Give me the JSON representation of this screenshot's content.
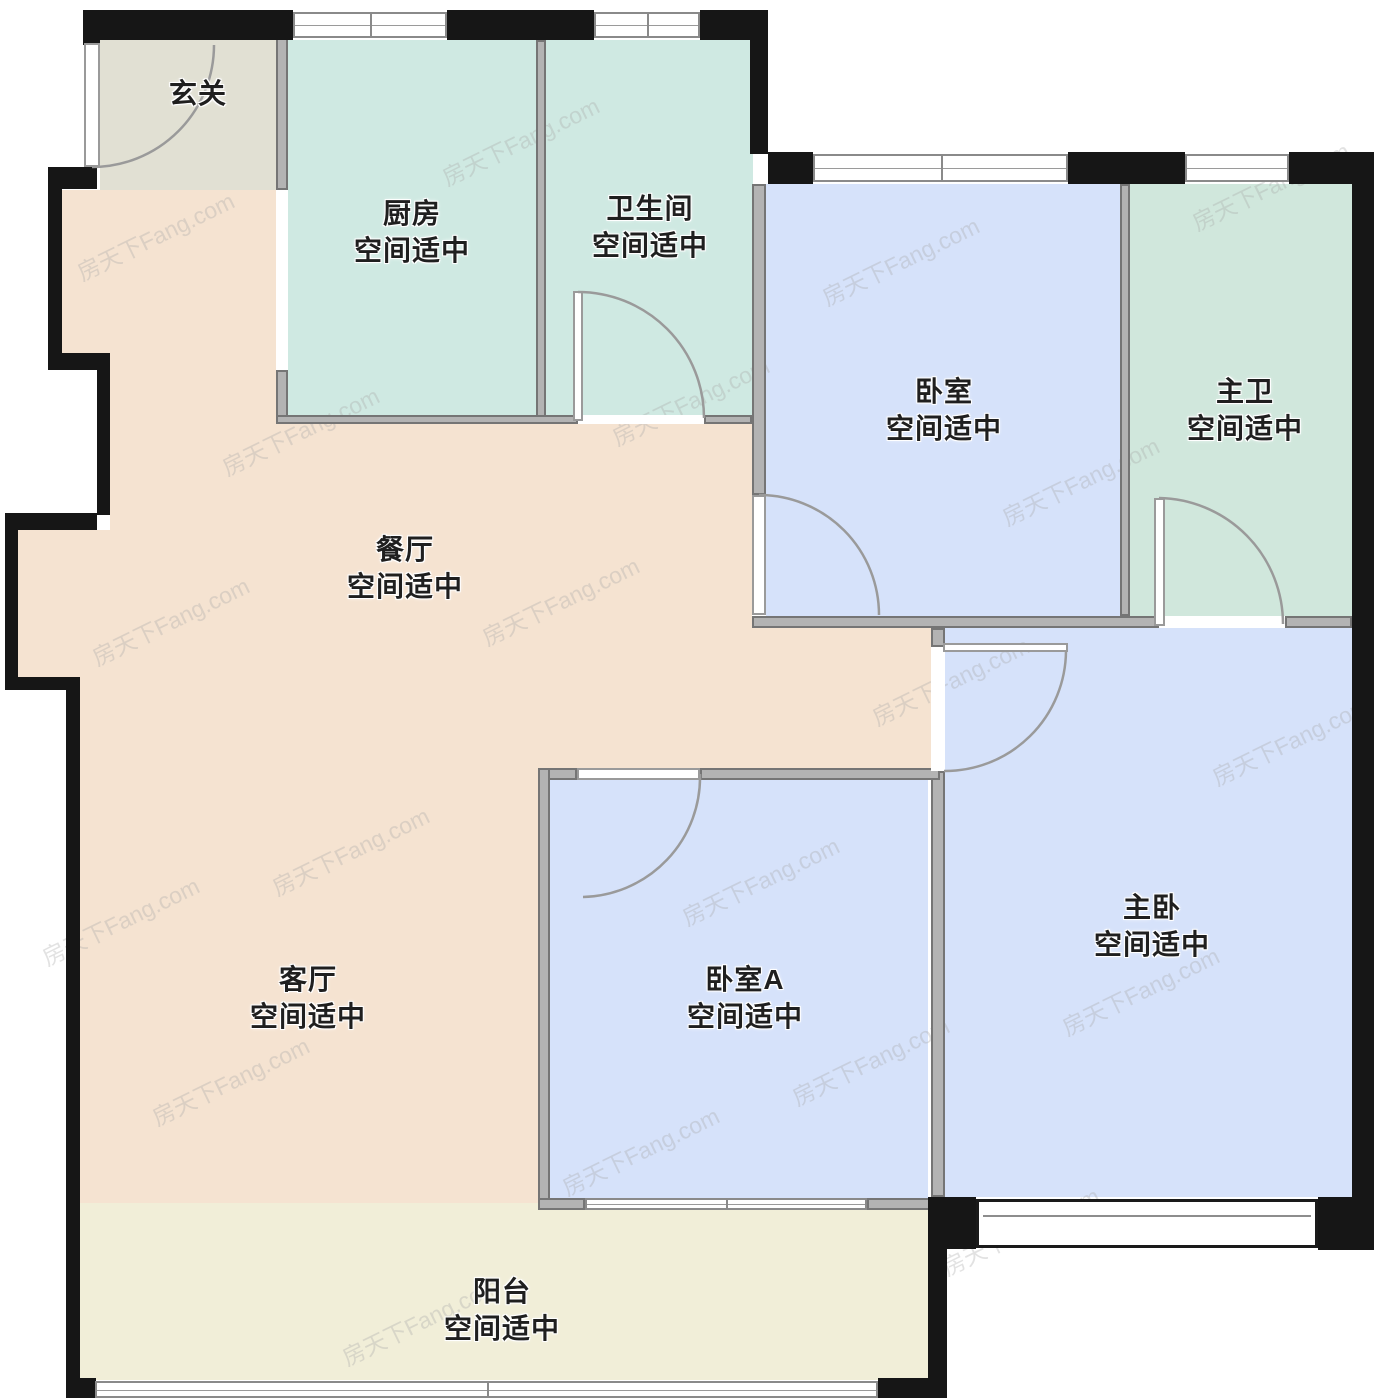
{
  "meta": {
    "title": "户型图 (floor plan)",
    "watermark_text": "房天下Fang.com",
    "canvas": {
      "width": 1374,
      "height": 1400
    }
  },
  "palette": {
    "outer_wall": "#161616",
    "inner_wall": "#b3b3b3",
    "teal_room": "#cfe9e2",
    "teal_room_dark": "#d0e7dc",
    "blue_room": "#d6e2fa",
    "peach_room": "#f5e3d1",
    "cream_room": "#f1eed8",
    "foyer_gray": "#e1e0d3",
    "arc_stroke": "#9a9a9a"
  },
  "fills": [
    {
      "id": "foyer",
      "color": "#e1e0d3",
      "rects": [
        [
          100,
          40,
          176,
          150
        ]
      ]
    },
    {
      "id": "kitchen",
      "color": "#cfe9e2",
      "rects": [
        [
          288,
          40,
          248,
          378
        ]
      ]
    },
    {
      "id": "bathroom",
      "color": "#cfe9e2",
      "rects": [
        [
          546,
          40,
          207,
          378
        ]
      ]
    },
    {
      "id": "bedroom",
      "color": "#d6e2fa",
      "rects": [
        [
          766,
          184,
          354,
          432
        ]
      ]
    },
    {
      "id": "master-bath",
      "color": "#d0e7dc",
      "rects": [
        [
          1130,
          184,
          222,
          432
        ]
      ]
    },
    {
      "id": "dining-living",
      "color": "#f5e3d1",
      "rects": [
        [
          62,
          190,
          214,
          165
        ],
        [
          110,
          353,
          166,
          70
        ],
        [
          110,
          423,
          642,
          107
        ],
        [
          18,
          530,
          734,
          147
        ],
        [
          752,
          628,
          179,
          140
        ],
        [
          78,
          677,
          460,
          526
        ],
        [
          538,
          677,
          393,
          91
        ]
      ]
    },
    {
      "id": "master-bedroom",
      "color": "#d6e2fa",
      "rects": [
        [
          945,
          628,
          407,
          569
        ]
      ]
    },
    {
      "id": "bedroom-a",
      "color": "#d6e2fa",
      "rects": [
        [
          550,
          780,
          378,
          418
        ]
      ]
    },
    {
      "id": "balcony",
      "color": "#f1eed8",
      "rects": [
        [
          80,
          1203,
          848,
          177
        ]
      ]
    }
  ],
  "labels": [
    {
      "id": "foyer",
      "lines": [
        "玄关"
      ],
      "x": 198,
      "y": 92
    },
    {
      "id": "kitchen",
      "lines": [
        "厨房",
        "空间适中"
      ],
      "x": 412,
      "y": 212
    },
    {
      "id": "bathroom",
      "lines": [
        "卫生间",
        "空间适中"
      ],
      "x": 650,
      "y": 207
    },
    {
      "id": "bedroom",
      "lines": [
        "卧室",
        "空间适中"
      ],
      "x": 944,
      "y": 390
    },
    {
      "id": "master-bath",
      "lines": [
        "主卫",
        "空间适中"
      ],
      "x": 1245,
      "y": 390
    },
    {
      "id": "dining",
      "lines": [
        "餐厅",
        "空间适中"
      ],
      "x": 405,
      "y": 548
    },
    {
      "id": "living",
      "lines": [
        "客厅",
        "空间适中"
      ],
      "x": 308,
      "y": 978
    },
    {
      "id": "bedroom-a",
      "lines": [
        "卧室A",
        "空间适中"
      ],
      "x": 745,
      "y": 978
    },
    {
      "id": "master-bedroom",
      "lines": [
        "主卧",
        "空间适中"
      ],
      "x": 1152,
      "y": 906
    },
    {
      "id": "balcony",
      "lines": [
        "阳台",
        "空间适中"
      ],
      "x": 502,
      "y": 1290
    }
  ],
  "walls": {
    "outer": [
      [
        83,
        10,
        210,
        30
      ],
      [
        447,
        10,
        147,
        30
      ],
      [
        700,
        10,
        68,
        30
      ],
      [
        750,
        38,
        18,
        116
      ],
      [
        768,
        152,
        45,
        32
      ],
      [
        1068,
        152,
        117,
        32
      ],
      [
        1289,
        152,
        85,
        32
      ],
      [
        1352,
        152,
        22,
        1062
      ],
      [
        1318,
        1197,
        56,
        53
      ],
      [
        928,
        1197,
        48,
        52
      ],
      [
        928,
        1249,
        19,
        149
      ],
      [
        66,
        1378,
        30,
        20
      ],
      [
        878,
        1378,
        50,
        20
      ],
      [
        83,
        10,
        17,
        35
      ],
      [
        48,
        167,
        49,
        22
      ],
      [
        48,
        167,
        14,
        190
      ],
      [
        48,
        353,
        62,
        17
      ],
      [
        97,
        353,
        13,
        162
      ],
      [
        5,
        513,
        92,
        17
      ],
      [
        5,
        513,
        13,
        168
      ],
      [
        5,
        677,
        73,
        13
      ],
      [
        66,
        677,
        14,
        703
      ]
    ],
    "inner": [
      [
        276,
        30,
        12,
        160
      ],
      [
        276,
        370,
        12,
        53
      ],
      [
        536,
        40,
        10,
        383
      ],
      [
        276,
        415,
        302,
        9
      ],
      [
        704,
        415,
        48,
        9
      ],
      [
        752,
        184,
        14,
        311
      ],
      [
        752,
        616,
        407,
        12
      ],
      [
        1285,
        616,
        67,
        12
      ],
      [
        1120,
        184,
        10,
        432
      ],
      [
        931,
        628,
        14,
        19
      ],
      [
        931,
        771,
        14,
        426
      ],
      [
        538,
        768,
        39,
        12
      ],
      [
        700,
        768,
        240,
        12
      ],
      [
        538,
        768,
        12,
        442
      ],
      [
        538,
        1198,
        47,
        12
      ],
      [
        867,
        1198,
        64,
        12
      ]
    ]
  },
  "windows": [
    {
      "rect": [
        293,
        12,
        154,
        26
      ],
      "panes": 2
    },
    {
      "rect": [
        594,
        12,
        106,
        26
      ],
      "panes": 2
    },
    {
      "rect": [
        813,
        154,
        255,
        28
      ],
      "panes": 2
    },
    {
      "rect": [
        1185,
        154,
        104,
        28
      ],
      "panes": 1
    },
    {
      "rect": [
        585,
        1198,
        282,
        12
      ],
      "panes": 2
    },
    {
      "rect": [
        95,
        1381,
        783,
        17
      ],
      "panes": 2
    }
  ],
  "bay_window": {
    "rect": [
      976,
      1199,
      342,
      49
    ]
  },
  "doors": [
    {
      "id": "entrance",
      "opening": [
        84,
        43,
        16,
        124
      ],
      "leaf": [
        84,
        43,
        16,
        124
      ],
      "arc": {
        "from": [
          92,
          167
        ],
        "to": [
          214,
          45
        ],
        "r": 122,
        "sweep": 0
      }
    },
    {
      "id": "bathroom",
      "opening": [
        578,
        415,
        126,
        9
      ],
      "leaf": [
        573,
        291,
        10,
        130
      ],
      "arc": {
        "from": [
          578,
          292
        ],
        "to": [
          704,
          418
        ],
        "r": 126,
        "sweep": 1
      }
    },
    {
      "id": "bedroom",
      "opening": [
        752,
        495,
        14,
        120
      ],
      "leaf": [
        752,
        495,
        14,
        120
      ],
      "arc": {
        "from": [
          759,
          495
        ],
        "to": [
          879,
          615
        ],
        "r": 120,
        "sweep": 1
      }
    },
    {
      "id": "master-bath",
      "opening": [
        1159,
        616,
        126,
        12
      ],
      "leaf": [
        1154,
        498,
        11,
        128
      ],
      "arc": {
        "from": [
          1159,
          498
        ],
        "to": [
          1283,
          624
        ],
        "r": 126,
        "sweep": 1
      }
    },
    {
      "id": "master",
      "opening": [
        931,
        647,
        14,
        124
      ],
      "leaf": [
        943,
        643,
        125,
        9
      ],
      "arc": {
        "from": [
          1066,
          651
        ],
        "to": [
          944,
          771
        ],
        "r": 121,
        "sweep": 1
      }
    },
    {
      "id": "bedroom-a",
      "opening": [
        577,
        768,
        123,
        12
      ],
      "leaf": [
        577,
        768,
        123,
        12
      ],
      "arc": {
        "from": [
          700,
          774
        ],
        "to": [
          583,
          897
        ],
        "r": 120,
        "sweep": 1
      }
    }
  ],
  "watermarks": [
    [
      155,
      235
    ],
    [
      520,
      140
    ],
    [
      900,
      260
    ],
    [
      1270,
      185
    ],
    [
      300,
      430
    ],
    [
      690,
      400
    ],
    [
      1080,
      480
    ],
    [
      170,
      620
    ],
    [
      560,
      600
    ],
    [
      950,
      680
    ],
    [
      1290,
      740
    ],
    [
      350,
      850
    ],
    [
      760,
      880
    ],
    [
      1140,
      990
    ],
    [
      120,
      920
    ],
    [
      230,
      1080
    ],
    [
      640,
      1150
    ],
    [
      1020,
      1230
    ],
    [
      870,
      1060
    ],
    [
      420,
      1320
    ]
  ]
}
